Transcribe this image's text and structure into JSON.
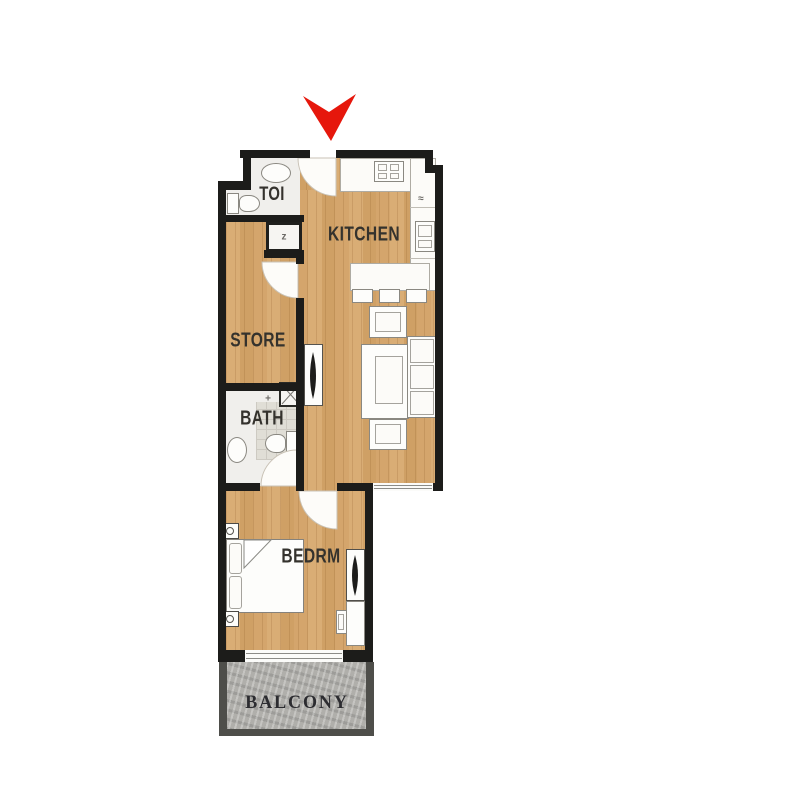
{
  "plan": {
    "labels": {
      "toi": "TOI",
      "kitchen": "KITCHEN",
      "store": "STORE",
      "bath": "BATH",
      "bedrm": "BEDRM",
      "balcony": "BALCONY"
    },
    "glyphs": {
      "utility_closet": "z",
      "bath_mark": "+",
      "counter_mark": "≈"
    },
    "colors": {
      "wall": "#1c1c1a",
      "wood_floor": "#d4a56c",
      "bath_tile": "#e0ded6",
      "balcony_floor": "#b0afab",
      "balcony_wall": "#4e4e4a",
      "entrance_arrow": "#e6170c"
    },
    "icons": {
      "entrance": "entrance-arrow-icon"
    }
  }
}
